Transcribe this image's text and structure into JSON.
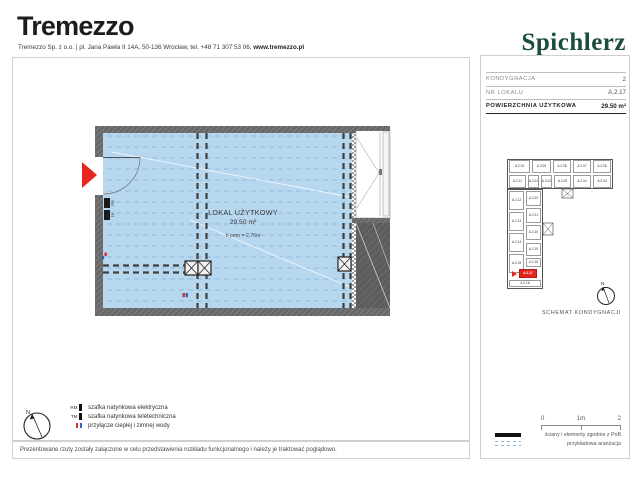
{
  "header": {
    "brand": "Tremezzo",
    "address_line": "Tremezzo Sp. z o.o. | pl. Jana Pawła II 14A, 50-136 Wrocław, tel. +48 71 307 53 06, ",
    "website": "www.tremezzo.pl",
    "project": "Spichlerz"
  },
  "info_panel": {
    "rows": [
      {
        "label": "KONDYGNACJA",
        "value": "2"
      },
      {
        "label": "NR LOKALU",
        "value": "A.2.17"
      },
      {
        "label": "POWIERZCHNIA UŻYTKOWA",
        "value": "29.50 m²"
      }
    ]
  },
  "floorplan": {
    "room_label": "LOKAL UŻYTKOWY",
    "room_area": "29.50 m²",
    "room_height_note": "h pom = 2,75m",
    "cabinet_rm": "RM",
    "cabinet_tm": "TM"
  },
  "legend": {
    "items": [
      {
        "prefix": "RM",
        "label": "szafka natynkowa elektryczna"
      },
      {
        "prefix": "TM",
        "label": "szafka natynkowa teletechniczna"
      },
      {
        "prefix": "",
        "label": "przyłącze ciepłej i zimnej wody"
      }
    ]
  },
  "disclaimer": "Prezentowane rzuty zostały załączone w celu przedstawienia rozkładu funkcjonalnego  i należy je traktować poglądowo.",
  "schematic": {
    "caption": "SCHEMAT KONDYGNACJI",
    "highlighted_unit": "A.2.17",
    "units": [
      {
        "label": "A.2.10",
        "x": 2,
        "y": 1,
        "w": 21,
        "h": 13
      },
      {
        "label": "A.2.09",
        "x": 25,
        "y": 1,
        "w": 19,
        "h": 13
      },
      {
        "label": "A.2.08",
        "x": 46,
        "y": 1,
        "w": 18,
        "h": 13
      },
      {
        "label": "A.2.07",
        "x": 66,
        "y": 1,
        "w": 18,
        "h": 13
      },
      {
        "label": "A.2.06",
        "x": 86,
        "y": 1,
        "w": 18,
        "h": 13
      },
      {
        "label": "A.2.11",
        "x": 2,
        "y": 16,
        "w": 17,
        "h": 13
      },
      {
        "label": "A.2.01",
        "x": 21,
        "y": 16,
        "w": 11,
        "h": 13
      },
      {
        "label": "A.2.02",
        "x": 34,
        "y": 16,
        "w": 11,
        "h": 13
      },
      {
        "label": "A.2.05",
        "x": 47,
        "y": 16,
        "w": 17,
        "h": 13
      },
      {
        "label": "A.2.04",
        "x": 66,
        "y": 16,
        "w": 18,
        "h": 13
      },
      {
        "label": "A.2.03",
        "x": 86,
        "y": 16,
        "w": 18,
        "h": 13
      },
      {
        "label": "A.2.12",
        "x": 2,
        "y": 32,
        "w": 15,
        "h": 19
      },
      {
        "label": "A.2.13",
        "x": 2,
        "y": 53,
        "w": 15,
        "h": 19
      },
      {
        "label": "A.2.14",
        "x": 2,
        "y": 74,
        "w": 15,
        "h": 19
      },
      {
        "label": "A.2.15",
        "x": 2,
        "y": 95,
        "w": 15,
        "h": 19
      },
      {
        "label": "A.2.22",
        "x": 19,
        "y": 32,
        "w": 15,
        "h": 15
      },
      {
        "label": "A.2.21",
        "x": 19,
        "y": 49,
        "w": 15,
        "h": 15
      },
      {
        "label": "A.2.20",
        "x": 19,
        "y": 66,
        "w": 15,
        "h": 15
      },
      {
        "label": "A.2.19",
        "x": 19,
        "y": 84,
        "w": 15,
        "h": 13
      },
      {
        "label": "A.2.18",
        "x": 19,
        "y": 99,
        "w": 15,
        "h": 9
      },
      {
        "label": "A.2.17",
        "x": 12,
        "y": 110,
        "w": 18,
        "h": 9,
        "highlight": true
      },
      {
        "label": "A.2.16",
        "x": 2,
        "y": 121,
        "w": 32,
        "h": 7
      }
    ]
  },
  "scale_bar": {
    "labels": [
      "0",
      "1m",
      "2"
    ]
  },
  "plan_legend": {
    "items": [
      {
        "label": "ściany i elementy zgodnie z PnB"
      },
      {
        "label": "przykładowa aranżacja"
      }
    ]
  },
  "compass": {
    "north_label": "N"
  },
  "colors": {
    "accent_red": "#e8251c",
    "brand_green": "#1c4c3b",
    "room_fill": "#b7d7ee",
    "wall_gray": "#686868"
  }
}
